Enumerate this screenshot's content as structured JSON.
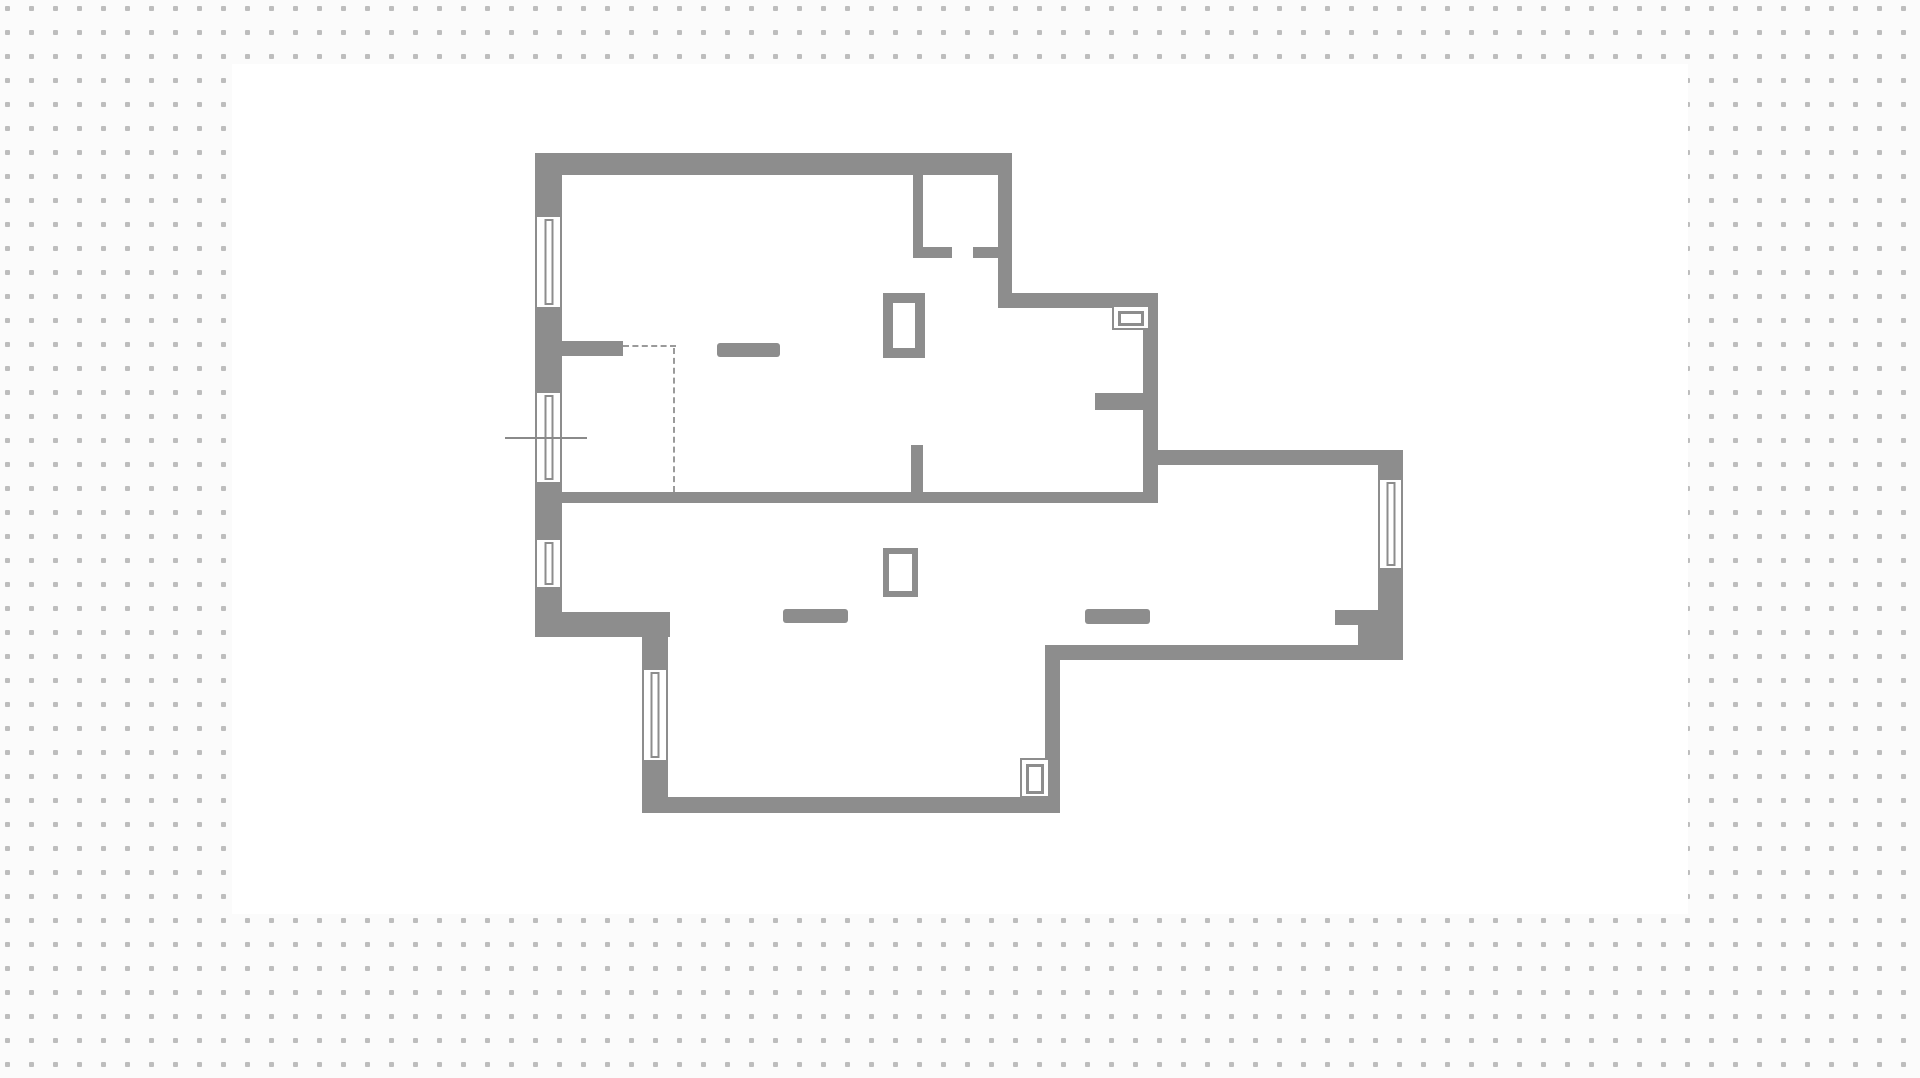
{
  "app": {
    "type": "floor-plan canvas",
    "visible_text": "none"
  },
  "canvas": {
    "width": 1920,
    "height": 1078,
    "background_color": "#fbfbfb",
    "grid": {
      "spacing": 24,
      "dot_size": 5,
      "dot_color": "#bdbdbd",
      "offset_x": 5,
      "offset_y": 6
    },
    "drawing_area": {
      "x": 232,
      "y": 64,
      "width": 1456,
      "height": 850,
      "color": "#ffffff"
    }
  },
  "floorplan": {
    "wall_color": "#8d8d8d",
    "annotation_color": "#9a9a9a",
    "section_line_color": "#8a8a8a",
    "walls": [
      {
        "name": "top-wall",
        "x": 535,
        "y": 153,
        "w": 477,
        "h": 22
      },
      {
        "name": "left-wall-pier-top",
        "x": 535,
        "y": 153,
        "w": 27,
        "h": 64
      },
      {
        "name": "left-wall-pier-2",
        "x": 535,
        "y": 307,
        "w": 27,
        "h": 86
      },
      {
        "name": "left-wall-pier-3",
        "x": 535,
        "y": 482,
        "w": 27,
        "h": 58
      },
      {
        "name": "left-wall-pier-4",
        "x": 535,
        "y": 587,
        "w": 27,
        "h": 50
      },
      {
        "name": "small-room-left-wall",
        "x": 913,
        "y": 175,
        "w": 10,
        "h": 83
      },
      {
        "name": "small-room-door-stub-left",
        "x": 923,
        "y": 247,
        "w": 29,
        "h": 11
      },
      {
        "name": "small-room-door-stub-right",
        "x": 973,
        "y": 247,
        "w": 25,
        "h": 11
      },
      {
        "name": "upper-right-outer-wall",
        "x": 998,
        "y": 175,
        "w": 14,
        "h": 118
      },
      {
        "name": "upper-step-wall-horizontal",
        "x": 998,
        "y": 293,
        "w": 160,
        "h": 15
      },
      {
        "name": "upper-step-wall-vertical",
        "x": 1143,
        "y": 293,
        "w": 15,
        "h": 210
      },
      {
        "name": "hallway-stub-wall",
        "x": 1095,
        "y": 393,
        "w": 48,
        "h": 17
      },
      {
        "name": "middle-dividing-wall",
        "x": 562,
        "y": 492,
        "w": 596,
        "h": 11
      },
      {
        "name": "middle-wall-stub-up",
        "x": 911,
        "y": 445,
        "w": 12,
        "h": 47
      },
      {
        "name": "closet-stub-wall",
        "x": 562,
        "y": 341,
        "w": 61,
        "h": 15
      },
      {
        "name": "left-step-wall",
        "x": 535,
        "y": 612,
        "w": 135,
        "h": 25
      },
      {
        "name": "lower-left-pier-top",
        "x": 642,
        "y": 637,
        "w": 26,
        "h": 33
      },
      {
        "name": "lower-left-pier-bottom",
        "x": 642,
        "y": 760,
        "w": 26,
        "h": 38
      },
      {
        "name": "bottom-wall",
        "x": 642,
        "y": 797,
        "w": 418,
        "h": 16
      },
      {
        "name": "lower-right-wall",
        "x": 1045,
        "y": 645,
        "w": 15,
        "h": 166
      },
      {
        "name": "wing-bottom-wall",
        "x": 1045,
        "y": 645,
        "w": 358,
        "h": 15
      },
      {
        "name": "wing-top-wall",
        "x": 1143,
        "y": 450,
        "w": 260,
        "h": 15
      },
      {
        "name": "right-wall-upper-block",
        "x": 1378,
        "y": 450,
        "w": 25,
        "h": 30
      },
      {
        "name": "right-wall-lower-block",
        "x": 1378,
        "y": 568,
        "w": 25,
        "h": 92
      },
      {
        "name": "alcove-stub-wall",
        "x": 1335,
        "y": 610,
        "w": 43,
        "h": 15
      },
      {
        "name": "alcove-filler-wall",
        "x": 1358,
        "y": 625,
        "w": 20,
        "h": 20
      }
    ],
    "windows": [
      {
        "name": "window-1",
        "x": 535,
        "y": 217,
        "w": 27,
        "h": 90
      },
      {
        "name": "window-2",
        "x": 535,
        "y": 393,
        "w": 27,
        "h": 89
      },
      {
        "name": "window-3",
        "x": 535,
        "y": 540,
        "w": 27,
        "h": 47
      },
      {
        "name": "window-4",
        "x": 642,
        "y": 670,
        "w": 26,
        "h": 90
      },
      {
        "name": "window-5",
        "x": 1378,
        "y": 480,
        "w": 25,
        "h": 88
      }
    ],
    "bars": [
      {
        "name": "upper-room-wall-bar",
        "x": 717,
        "y": 343,
        "w": 63,
        "h": 14
      },
      {
        "name": "lower-room-wall-bar",
        "x": 783,
        "y": 609,
        "w": 65,
        "h": 14
      },
      {
        "name": "corridor-wall-bar",
        "x": 1085,
        "y": 609,
        "w": 65,
        "h": 15
      }
    ],
    "fixtures": [
      {
        "name": "shaft-upper-room",
        "x": 883,
        "y": 293,
        "w": 42,
        "h": 65,
        "border": 10
      },
      {
        "name": "shaft-lower-room",
        "x": 883,
        "y": 548,
        "w": 35,
        "h": 49,
        "border": 6
      }
    ],
    "door_symbols": [
      {
        "name": "door-symbol-upper",
        "x": 1112,
        "y": 305,
        "w": 38,
        "h": 25
      },
      {
        "name": "door-symbol-lower",
        "x": 1020,
        "y": 758,
        "w": 30,
        "h": 40
      }
    ],
    "dashed_lines": [
      {
        "name": "planned-wall-dashed-horizontal",
        "x": 623,
        "y": 345,
        "length": 53,
        "orientation": "h"
      },
      {
        "name": "planned-wall-dashed-vertical",
        "x": 673,
        "y": 348,
        "length": 144,
        "orientation": "v"
      }
    ],
    "section_line": {
      "name": "section-line",
      "x": 505,
      "y": 437,
      "length": 82,
      "thickness": 2
    }
  }
}
